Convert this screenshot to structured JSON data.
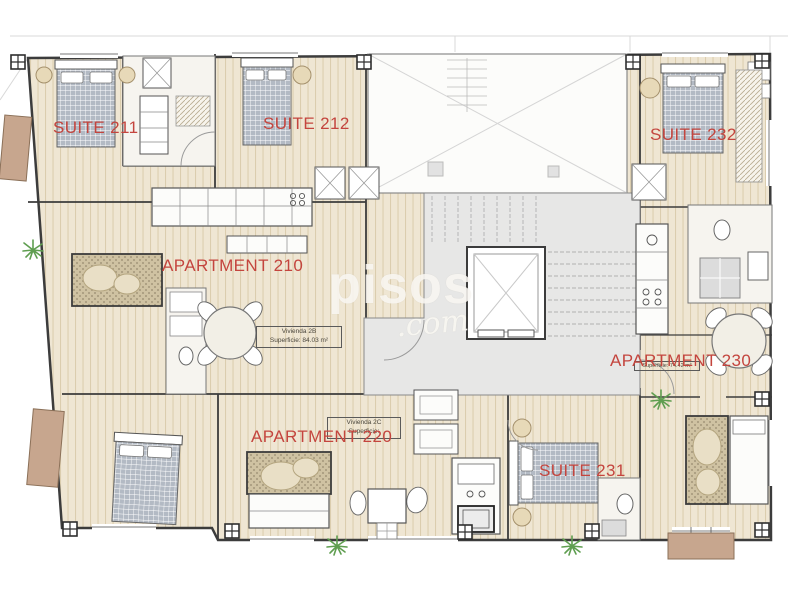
{
  "plan": {
    "watermark": {
      "brand": "pisos",
      "tld": ".com"
    },
    "rooms": [
      {
        "id": "suite-211",
        "label": "SUITE 211"
      },
      {
        "id": "suite-212",
        "label": "SUITE 212"
      },
      {
        "id": "suite-232",
        "label": "SUITE 232"
      },
      {
        "id": "apartment-210",
        "label": "APARTMENT 210"
      },
      {
        "id": "apartment-230",
        "label": "APARTMENT 230"
      },
      {
        "id": "apartment-220",
        "label": "APARTMENT 220"
      },
      {
        "id": "suite-231",
        "label": "SUITE 231"
      }
    ],
    "area_tags": [
      {
        "id": "vivienda-2b",
        "line1": "Vivienda 2B",
        "line2": "Superficie: 84.03 m²"
      },
      {
        "id": "vivienda-2c",
        "line1": "Vivienda 2C",
        "line2": "Superficie:"
      },
      {
        "id": "apartment-230-area",
        "line1": "Superficie: 74.42 m²"
      }
    ],
    "colors": {
      "label_red": "#c4453e",
      "floor_beige": "#efe6d3",
      "floor_stripe": "#dbcdae",
      "wall_dark": "#3c3c3c",
      "stair_gray": "#e7e7e6",
      "balcony_brown": "#c7a68e",
      "bed_gray": "#b3bac4",
      "plant_green": "#5f9e50",
      "watermark_white": "rgba(252,250,246,0.82)"
    }
  }
}
